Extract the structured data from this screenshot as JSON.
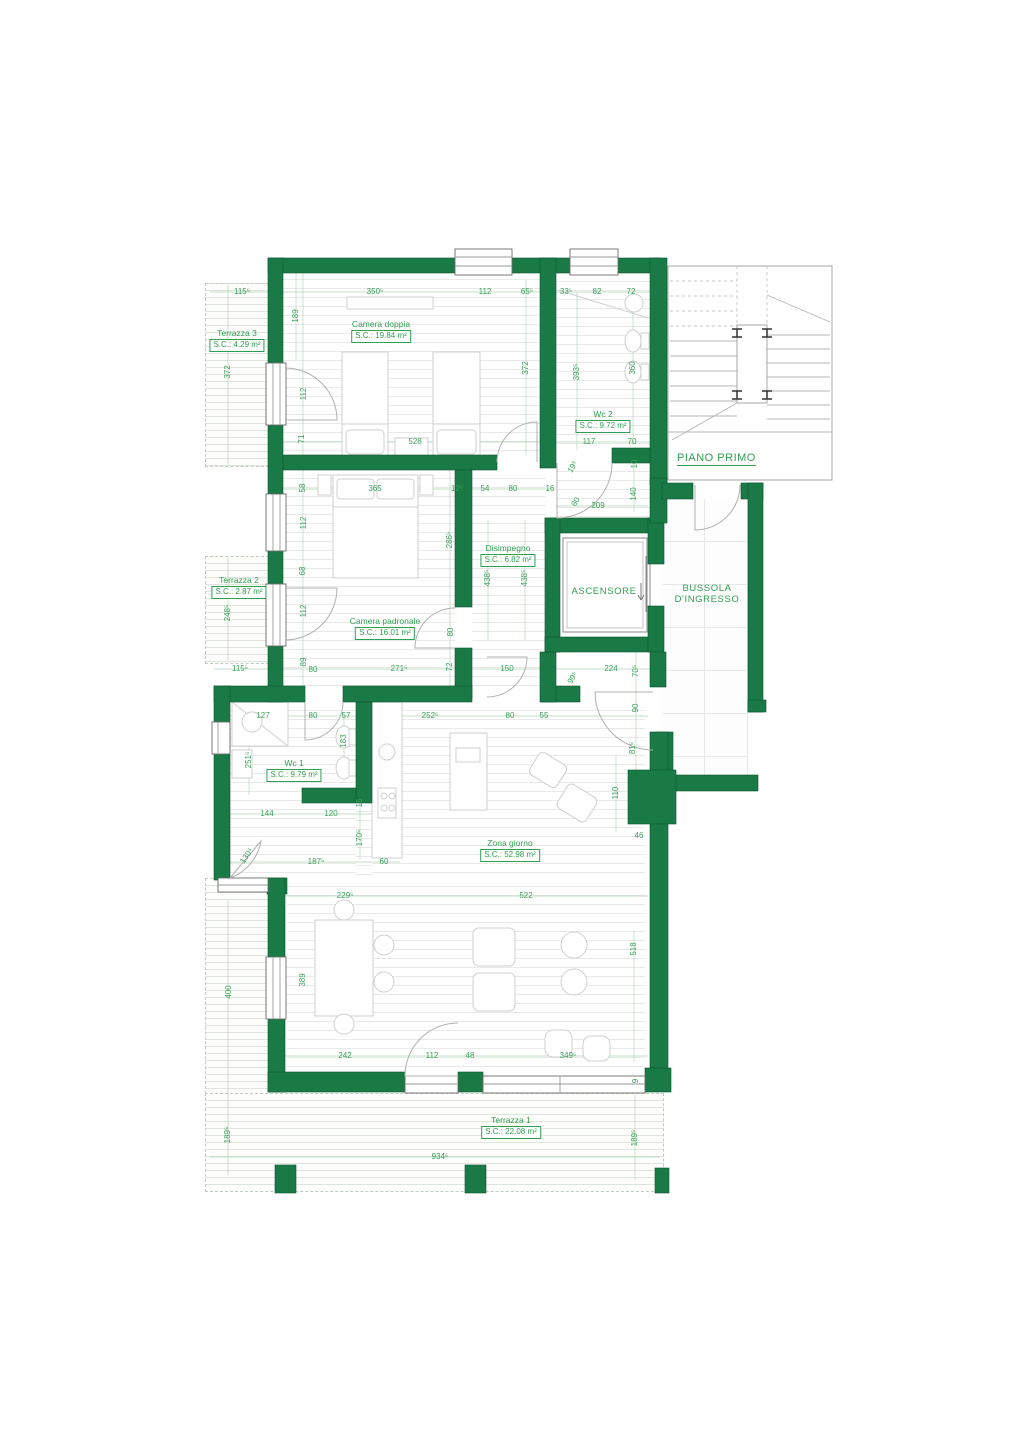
{
  "colors": {
    "wall_green": "#1a7a45",
    "wall_edge_green": "#0c5531",
    "dimension_green": "#3aa05a",
    "label_green": "#2f9e52"
  },
  "labels": {
    "ascensore": "ASCENSORE",
    "bussola_line1": "BUSSOLA",
    "bussola_line2": "D'INGRESSO",
    "piano_primo": "PIANO PRIMO"
  },
  "rooms": [
    {
      "name": "Terrazza 3",
      "area": "S.C.: 4.29 m²",
      "x": 237,
      "y": 328
    },
    {
      "name": "Camera doppia",
      "area": "S.C.: 19.84 m²",
      "x": 381,
      "y": 319
    },
    {
      "name": "Wc 2",
      "area": "S.C.: 9.72 m²",
      "x": 603,
      "y": 409
    },
    {
      "name": "Terrazza 2",
      "area": "S.C.: 2.87 m²",
      "x": 239,
      "y": 575
    },
    {
      "name": "Disimpegno",
      "area": "S.C.: 6.82 m²",
      "x": 508,
      "y": 543
    },
    {
      "name": "Camera padronale",
      "area": "S.C.: 16.01 m²",
      "x": 385,
      "y": 616
    },
    {
      "name": "Wc 1",
      "area": "S.C.: 9.79 m²",
      "x": 294,
      "y": 758
    },
    {
      "name": "Zona giorno",
      "area": "S.C.: 52.98 m²",
      "x": 510,
      "y": 838
    },
    {
      "name": "Terrazza 1",
      "area": "S.C.: 22.08 m²",
      "x": 511,
      "y": 1115
    }
  ],
  "dimensions": [
    {
      "t": "115⁵",
      "x": 242,
      "y": 292
    },
    {
      "t": "350⁵",
      "x": 375,
      "y": 292
    },
    {
      "t": "112",
      "x": 485,
      "y": 292
    },
    {
      "t": "65⁵",
      "x": 527,
      "y": 292
    },
    {
      "t": "33⁵",
      "x": 566,
      "y": 292
    },
    {
      "t": "82",
      "x": 597,
      "y": 292
    },
    {
      "t": "72",
      "x": 631,
      "y": 292
    },
    {
      "t": "189",
      "x": 296,
      "y": 316,
      "r": -90
    },
    {
      "t": "372",
      "x": 228,
      "y": 372,
      "r": -90
    },
    {
      "t": "112",
      "x": 304,
      "y": 394,
      "r": -90
    },
    {
      "t": "372",
      "x": 526,
      "y": 368,
      "r": -90
    },
    {
      "t": "393⁵",
      "x": 577,
      "y": 372,
      "r": -90
    },
    {
      "t": "360",
      "x": 633,
      "y": 368,
      "r": -90
    },
    {
      "t": "71",
      "x": 302,
      "y": 439,
      "r": -90
    },
    {
      "t": "528",
      "x": 415,
      "y": 442
    },
    {
      "t": "117",
      "x": 589,
      "y": 442
    },
    {
      "t": "70",
      "x": 632,
      "y": 442
    },
    {
      "t": "19⁵",
      "x": 573,
      "y": 467,
      "r": -60
    },
    {
      "t": "10",
      "x": 635,
      "y": 464,
      "r": -90
    },
    {
      "t": "58",
      "x": 303,
      "y": 488,
      "r": -90
    },
    {
      "t": "365",
      "x": 375,
      "y": 489
    },
    {
      "t": "12⁵",
      "x": 457,
      "y": 489
    },
    {
      "t": "54",
      "x": 485,
      "y": 489
    },
    {
      "t": "80",
      "x": 513,
      "y": 489
    },
    {
      "t": "16",
      "x": 550,
      "y": 489
    },
    {
      "t": "80",
      "x": 576,
      "y": 502,
      "r": -60
    },
    {
      "t": "209",
      "x": 598,
      "y": 506
    },
    {
      "t": "140",
      "x": 634,
      "y": 494,
      "r": -90
    },
    {
      "t": "112",
      "x": 304,
      "y": 523,
      "r": -90
    },
    {
      "t": "286⁵",
      "x": 450,
      "y": 540,
      "r": -90
    },
    {
      "t": "68",
      "x": 303,
      "y": 571,
      "r": -90
    },
    {
      "t": "438⁵",
      "x": 488,
      "y": 578,
      "r": -90
    },
    {
      "t": "438⁵",
      "x": 525,
      "y": 578,
      "r": -90
    },
    {
      "t": "248⁵",
      "x": 228,
      "y": 613,
      "r": -90
    },
    {
      "t": "112",
      "x": 304,
      "y": 611,
      "r": -90
    },
    {
      "t": "80",
      "x": 451,
      "y": 632,
      "r": -90
    },
    {
      "t": "115⁵",
      "x": 240,
      "y": 669
    },
    {
      "t": "89",
      "x": 304,
      "y": 662,
      "r": -90
    },
    {
      "t": "80",
      "x": 313,
      "y": 670
    },
    {
      "t": "271⁵",
      "x": 399,
      "y": 669
    },
    {
      "t": "72",
      "x": 450,
      "y": 667,
      "r": -90
    },
    {
      "t": "150",
      "x": 507,
      "y": 669
    },
    {
      "t": "99⁵",
      "x": 573,
      "y": 678,
      "r": -60
    },
    {
      "t": "224",
      "x": 611,
      "y": 669
    },
    {
      "t": "70⁵",
      "x": 636,
      "y": 671,
      "r": -90
    },
    {
      "t": "90",
      "x": 636,
      "y": 708,
      "r": -90
    },
    {
      "t": "127",
      "x": 263,
      "y": 716
    },
    {
      "t": "80",
      "x": 313,
      "y": 716
    },
    {
      "t": "57",
      "x": 346,
      "y": 716
    },
    {
      "t": "252⁵",
      "x": 430,
      "y": 716
    },
    {
      "t": "80",
      "x": 510,
      "y": 716
    },
    {
      "t": "55",
      "x": 544,
      "y": 716
    },
    {
      "t": "183",
      "x": 344,
      "y": 741,
      "r": -90
    },
    {
      "t": "251⁵",
      "x": 249,
      "y": 760,
      "r": -90
    },
    {
      "t": "15",
      "x": 360,
      "y": 803,
      "r": -90
    },
    {
      "t": "81⁵",
      "x": 633,
      "y": 748,
      "r": -90
    },
    {
      "t": "110",
      "x": 616,
      "y": 793,
      "r": -90
    },
    {
      "t": "144",
      "x": 267,
      "y": 814
    },
    {
      "t": "120",
      "x": 331,
      "y": 814
    },
    {
      "t": "170⁵",
      "x": 360,
      "y": 838,
      "r": -90
    },
    {
      "t": "46",
      "x": 639,
      "y": 836
    },
    {
      "t": "130⁵",
      "x": 247,
      "y": 856,
      "r": -55
    },
    {
      "t": "187⁵",
      "x": 316,
      "y": 862
    },
    {
      "t": "60",
      "x": 384,
      "y": 862
    },
    {
      "t": "229⁵",
      "x": 345,
      "y": 896
    },
    {
      "t": "522",
      "x": 526,
      "y": 896
    },
    {
      "t": "389",
      "x": 303,
      "y": 980,
      "r": -90
    },
    {
      "t": "400",
      "x": 229,
      "y": 992,
      "r": -90
    },
    {
      "t": "518",
      "x": 634,
      "y": 949,
      "r": -90
    },
    {
      "t": "242",
      "x": 345,
      "y": 1056
    },
    {
      "t": "112",
      "x": 432,
      "y": 1056
    },
    {
      "t": "48",
      "x": 470,
      "y": 1056
    },
    {
      "t": "349⁵",
      "x": 568,
      "y": 1056
    },
    {
      "t": "9",
      "x": 636,
      "y": 1081,
      "r": -90
    },
    {
      "t": "189⁵",
      "x": 228,
      "y": 1135,
      "r": -90
    },
    {
      "t": "189⁵",
      "x": 635,
      "y": 1138,
      "r": -90
    },
    {
      "t": "934⁵",
      "x": 440,
      "y": 1157
    }
  ]
}
